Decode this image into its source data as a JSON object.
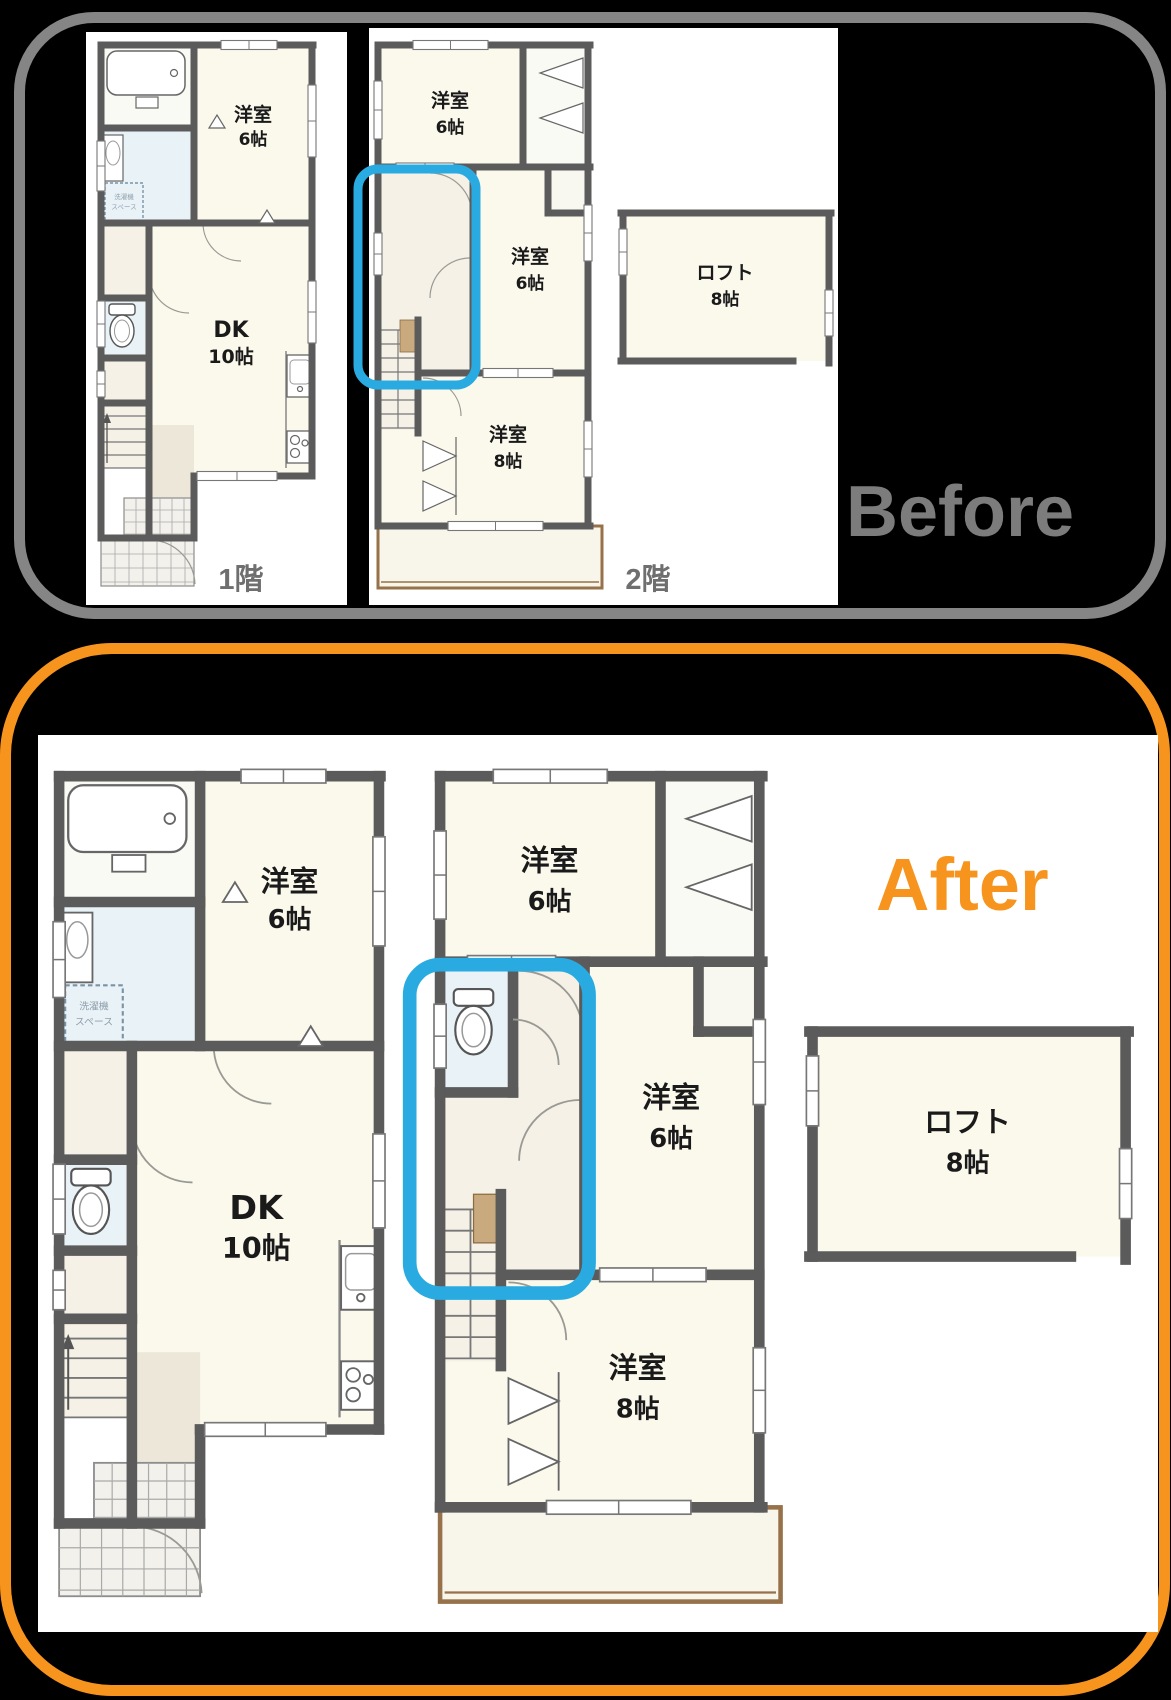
{
  "colors": {
    "background": "#000000",
    "before_border": "#858585",
    "before_title": "#7C7C7C",
    "after_border": "#F7941E",
    "after_title": "#F7941E",
    "highlight_box": "#29ABE2",
    "wall": "#5B5B5B",
    "room_fill": "#FBF8EC",
    "wet_room_fill": "#E9F2F6",
    "hall_fill": "#F5F1E6",
    "balcony_border": "#96714A"
  },
  "before": {
    "title": "Before",
    "floor1_caption": "1階",
    "floor2_caption": "2階"
  },
  "after": {
    "title": "After"
  },
  "rooms": {
    "floor1": {
      "bedroom_name": "洋室",
      "bedroom_size": "6帖",
      "dk_name": "DK",
      "dk_size": "10帖",
      "laundry_line1": "洗濯機",
      "laundry_line2": "スペース"
    },
    "floor2": {
      "bedroom_top_name": "洋室",
      "bedroom_top_size": "6帖",
      "bedroom_mid_name": "洋室",
      "bedroom_mid_size": "6帖",
      "bedroom_bottom_name": "洋室",
      "bedroom_bottom_size": "8帖",
      "loft_name": "ロフト",
      "loft_size": "8帖"
    }
  }
}
